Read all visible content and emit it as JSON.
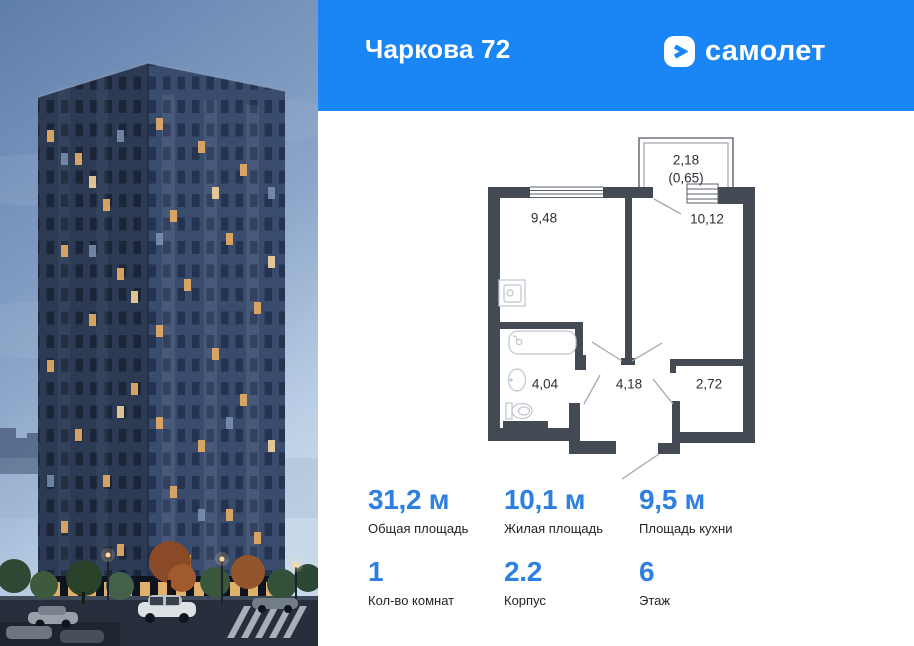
{
  "header": {
    "title": "Чаркова 72",
    "brand": "самолет",
    "bg_color": "#1a86f5"
  },
  "floorplan": {
    "balcony": {
      "area": "2,18",
      "reduced_area": "(0,65)"
    },
    "rooms": [
      {
        "name": "kitchen",
        "area": "9,48"
      },
      {
        "name": "living-room",
        "area": "10,12"
      },
      {
        "name": "bathroom",
        "area": "4,04"
      },
      {
        "name": "hallway",
        "area": "4,18"
      },
      {
        "name": "wardrobe",
        "area": "2,72"
      }
    ],
    "wall_color": "#444a54"
  },
  "stats": {
    "accent_color": "#2e7fe2",
    "row1": [
      {
        "value": "31,2 м",
        "label": "Общая площадь"
      },
      {
        "value": "10,1 м",
        "label": "Жилая площадь"
      },
      {
        "value": "9,5 м",
        "label": "Площадь кухни"
      }
    ],
    "row2": [
      {
        "value": "1",
        "label": "Кол-во комнат"
      },
      {
        "value": "2.2",
        "label": "Корпус"
      },
      {
        "value": "6",
        "label": "Этаж"
      }
    ]
  }
}
